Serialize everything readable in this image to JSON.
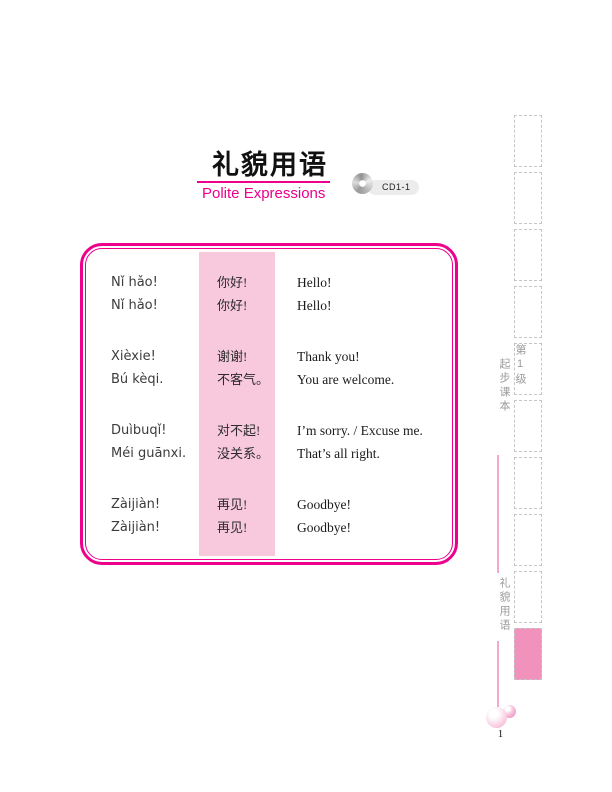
{
  "header": {
    "title_zh": "礼貌用语",
    "title_en": "Polite Expressions",
    "cd_badge": "CD1-1",
    "cd_icon": "cd-disc-icon"
  },
  "phrase_table": {
    "groups": [
      {
        "rows": [
          {
            "pinyin": "Nǐ hǎo!",
            "hanzi": "你好!",
            "english": "Hello!"
          },
          {
            "pinyin": "Nǐ hǎo!",
            "hanzi": "你好!",
            "english": "Hello!"
          }
        ]
      },
      {
        "rows": [
          {
            "pinyin": "Xièxie!",
            "hanzi": "谢谢!",
            "english": "Thank you!"
          },
          {
            "pinyin": "Bú kèqi.",
            "hanzi": "不客气。",
            "english": "You are welcome."
          }
        ]
      },
      {
        "rows": [
          {
            "pinyin": "Duìbuqǐ!",
            "hanzi": "对不起!",
            "english": "I’m sorry. / Excuse me."
          },
          {
            "pinyin": "Méi guānxi.",
            "hanzi": "没关系。",
            "english": "That’s all right."
          }
        ]
      },
      {
        "rows": [
          {
            "pinyin": "Zàijiàn!",
            "hanzi": "再见!",
            "english": "Goodbye!"
          },
          {
            "pinyin": "Zàijiàn!",
            "hanzi": "再见!",
            "english": "Goodbye!"
          }
        ]
      }
    ]
  },
  "sidebar": {
    "level_label": "第1级",
    "book_label": "起步课本",
    "chapter_label": "礼貌用语",
    "tab_count": 10,
    "active_tab_index": 9
  },
  "footer": {
    "page_number": "1"
  },
  "colors": {
    "magenta": "#ec008c",
    "pink_column": "#f8c9dd",
    "tab_active": "#f192bc",
    "side_line": "#f3a9cd",
    "gray_text": "#9b9b9b"
  }
}
